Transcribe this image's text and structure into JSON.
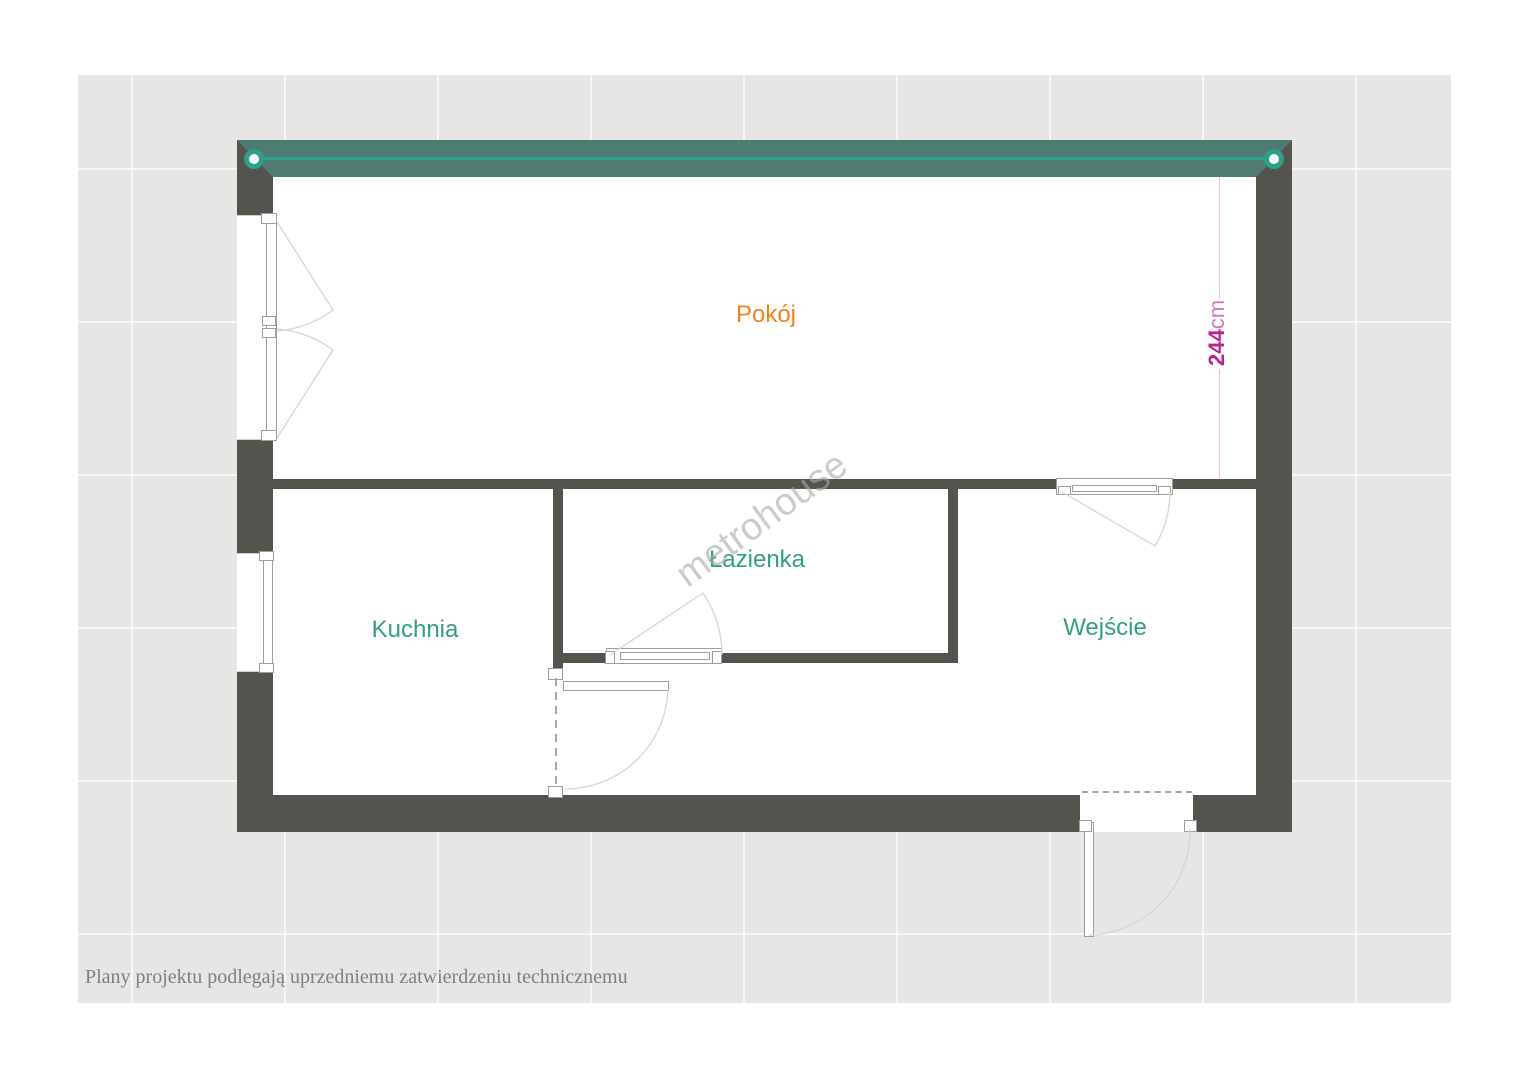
{
  "rooms": {
    "pokoj": {
      "label": "Pokój"
    },
    "lazienka": {
      "label": "Łazienka"
    },
    "kuchnia": {
      "label": "Kuchnia"
    },
    "wejscie": {
      "label": "Wejście"
    }
  },
  "dimension": {
    "value": "244",
    "unit": "cm"
  },
  "watermark": {
    "text": "metrohouse"
  },
  "footer": {
    "note": "Plany projektu podlegają uprzedniemu zatwierdzeniu technicznemu"
  },
  "colors": {
    "wall": "#55534e",
    "rail": "#4e7c72",
    "rail_line": "#2ca08a",
    "accent_teal": "#2f9e85",
    "accent_orange": "#f5801f",
    "dim_value": "#c21e8d",
    "dim_unit": "#cb7ec4",
    "dim_line": "#ecb9da",
    "watermark": "#a9a9a9",
    "footer": "#7f7f7f",
    "board": "#e7e6e5"
  }
}
